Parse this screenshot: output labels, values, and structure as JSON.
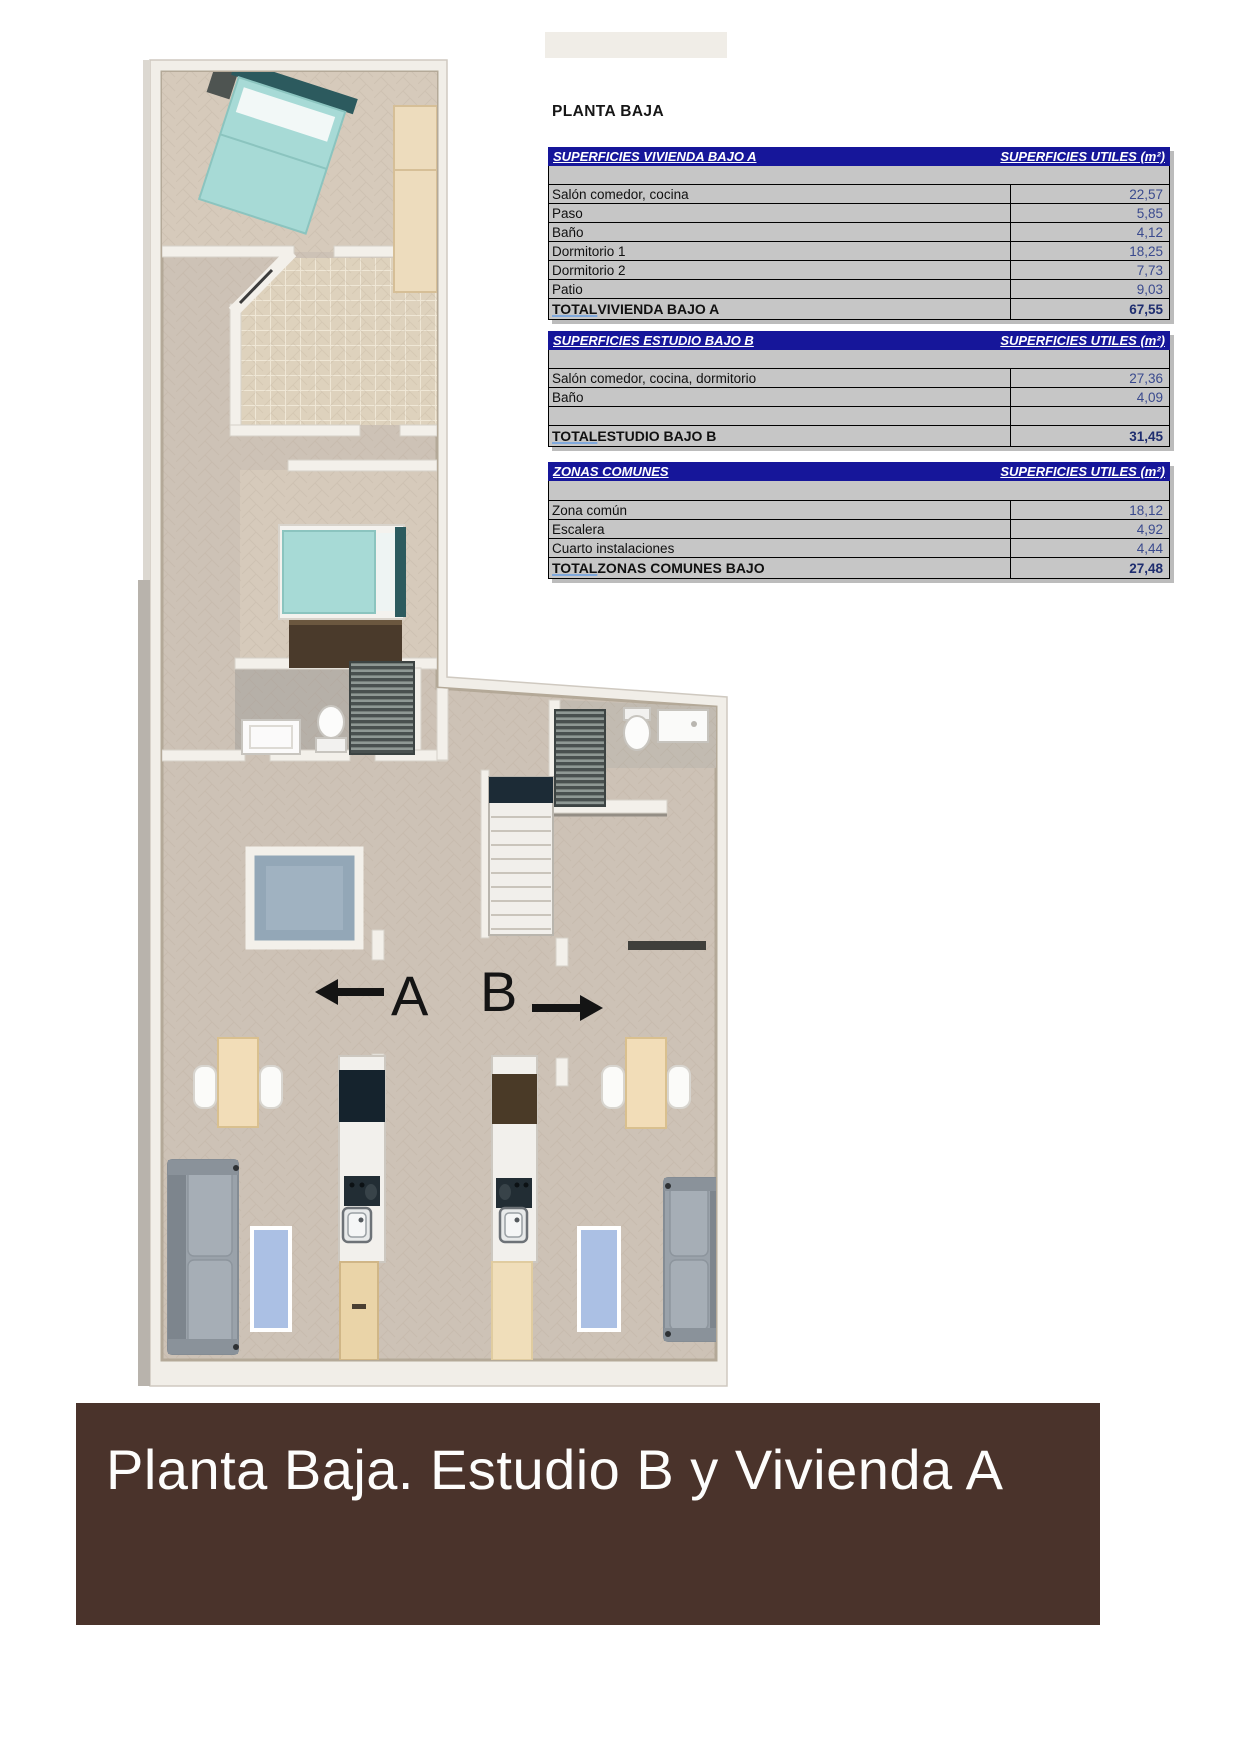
{
  "page": {
    "title_label": "PLANTA BAJA"
  },
  "tables": [
    {
      "title": "SUPERFICIES VIVIENDA BAJO A",
      "unit_header": "SUPERFICIES UTILES  (m²)",
      "rows": [
        {
          "label": "Salón comedor, cocina",
          "value": "22,57"
        },
        {
          "label": "Paso",
          "value": "5,85"
        },
        {
          "label": "Baño",
          "value": "4,12"
        },
        {
          "label": "Dormitorio 1",
          "value": "18,25"
        },
        {
          "label": "Dormitorio 2",
          "value": "7,73"
        },
        {
          "label": "Patio",
          "value": "9,03"
        }
      ],
      "total": {
        "word": "TOTAL",
        "rest": " VIVIENDA BAJO A",
        "value": "67,55"
      }
    },
    {
      "title": "SUPERFICIES ESTUDIO BAJO B",
      "unit_header": "SUPERFICIES UTILES  (m²)",
      "rows": [
        {
          "label": "Salón comedor, cocina, dormitorio",
          "value": "27,36"
        },
        {
          "label": "Baño",
          "value": "4,09"
        },
        {
          "label": "",
          "value": ""
        }
      ],
      "total": {
        "word": "TOTAL",
        "rest": " ESTUDIO BAJO B",
        "value": "31,45"
      }
    },
    {
      "title": "ZONAS COMUNES",
      "unit_header": "SUPERFICIES UTILES  (m²)",
      "rows": [
        {
          "label": "Zona común",
          "value": "18,12"
        },
        {
          "label": "Escalera",
          "value": "4,92"
        },
        {
          "label": "Cuarto instalaciones",
          "value": "4,44"
        }
      ],
      "total": {
        "word": "TOTAL",
        "rest": " ZONAS COMUNES BAJO",
        "value": "27,48"
      }
    }
  ],
  "floor_plan": {
    "unit_a_label": "A",
    "unit_b_label": "B"
  },
  "banner": {
    "text": "Planta Baja. Estudio B y Vivienda A"
  },
  "colors": {
    "table_header_bg": "#16169A",
    "table_bg": "#C6C6C6",
    "value_text": "#3A4A8E",
    "banner_bg": "#4A332B",
    "bed_teal": "#A7DAD6"
  }
}
